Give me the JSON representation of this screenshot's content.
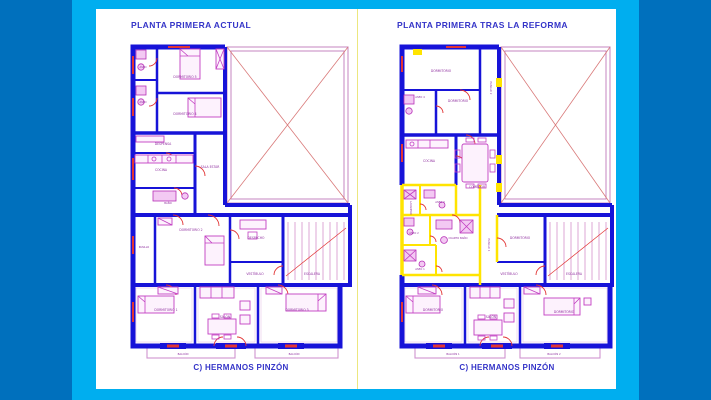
{
  "slide": {
    "background_outer": "#0070bd",
    "background_frame": "#00aeef",
    "page_color": "#ffffff",
    "divider_color": "#ece77f"
  },
  "palette": {
    "wall_blue": "#1713d8",
    "reform_yellow": "#ffe400",
    "furniture_magenta": "#c23fc2",
    "door_red": "#e23434",
    "patio_pink": "#c98fc5",
    "stair_pink": "#d492cc",
    "balcony_pink": "#cf93cf",
    "label_purple": "#8f2f9f",
    "title_blue": "#3434c8"
  },
  "plans": [
    {
      "title": "PLANTA PRIMERA ACTUAL",
      "caption": "C) HERMANOS PINZÓN",
      "rooms": [
        {
          "label": "ASEO"
        },
        {
          "label": "DORMITORIO 5"
        },
        {
          "label": "ASEO"
        },
        {
          "label": "DORMITORIO 4"
        },
        {
          "label": "DESPENSA"
        },
        {
          "label": "COCINA"
        },
        {
          "label": "SALA ESTAR"
        },
        {
          "label": "BAÑO"
        },
        {
          "label": "PASILLO"
        },
        {
          "label": "DORMITORIO 2"
        },
        {
          "label": "DESPACHO"
        },
        {
          "label": "VESTÍBULO"
        },
        {
          "label": "ESCALERA"
        },
        {
          "label": "DORMITORIO 1"
        },
        {
          "label": "SALÓN"
        },
        {
          "label": "DORMITORIO 3"
        },
        {
          "label": "BALCÓN"
        },
        {
          "label": "BALCÓN"
        }
      ]
    },
    {
      "title": "PLANTA PRIMERA TRAS LA REFORMA",
      "caption": "C) HERMANOS PINZÓN",
      "rooms": [
        {
          "label": "DORMITORIO"
        },
        {
          "label": "ASEO 4"
        },
        {
          "label": "DORMITORIO"
        },
        {
          "label": "PASILLO 2"
        },
        {
          "label": "COCINA"
        },
        {
          "label": "COMEDOR"
        },
        {
          "label": "LAVADERO"
        },
        {
          "label": "ASEO 3"
        },
        {
          "label": "ASEO 2"
        },
        {
          "label": "CUARTO BAÑO"
        },
        {
          "label": "ASEO 1"
        },
        {
          "label": "PASILLO 1"
        },
        {
          "label": "DORMITORIO"
        },
        {
          "label": "VESTÍBULO"
        },
        {
          "label": "ESCALERA"
        },
        {
          "label": "DORMITORIO"
        },
        {
          "label": "SALÓN"
        },
        {
          "label": "DORMITORIO"
        },
        {
          "label": "BALCÓN 1"
        },
        {
          "label": "BALCÓN 2"
        }
      ]
    }
  ]
}
